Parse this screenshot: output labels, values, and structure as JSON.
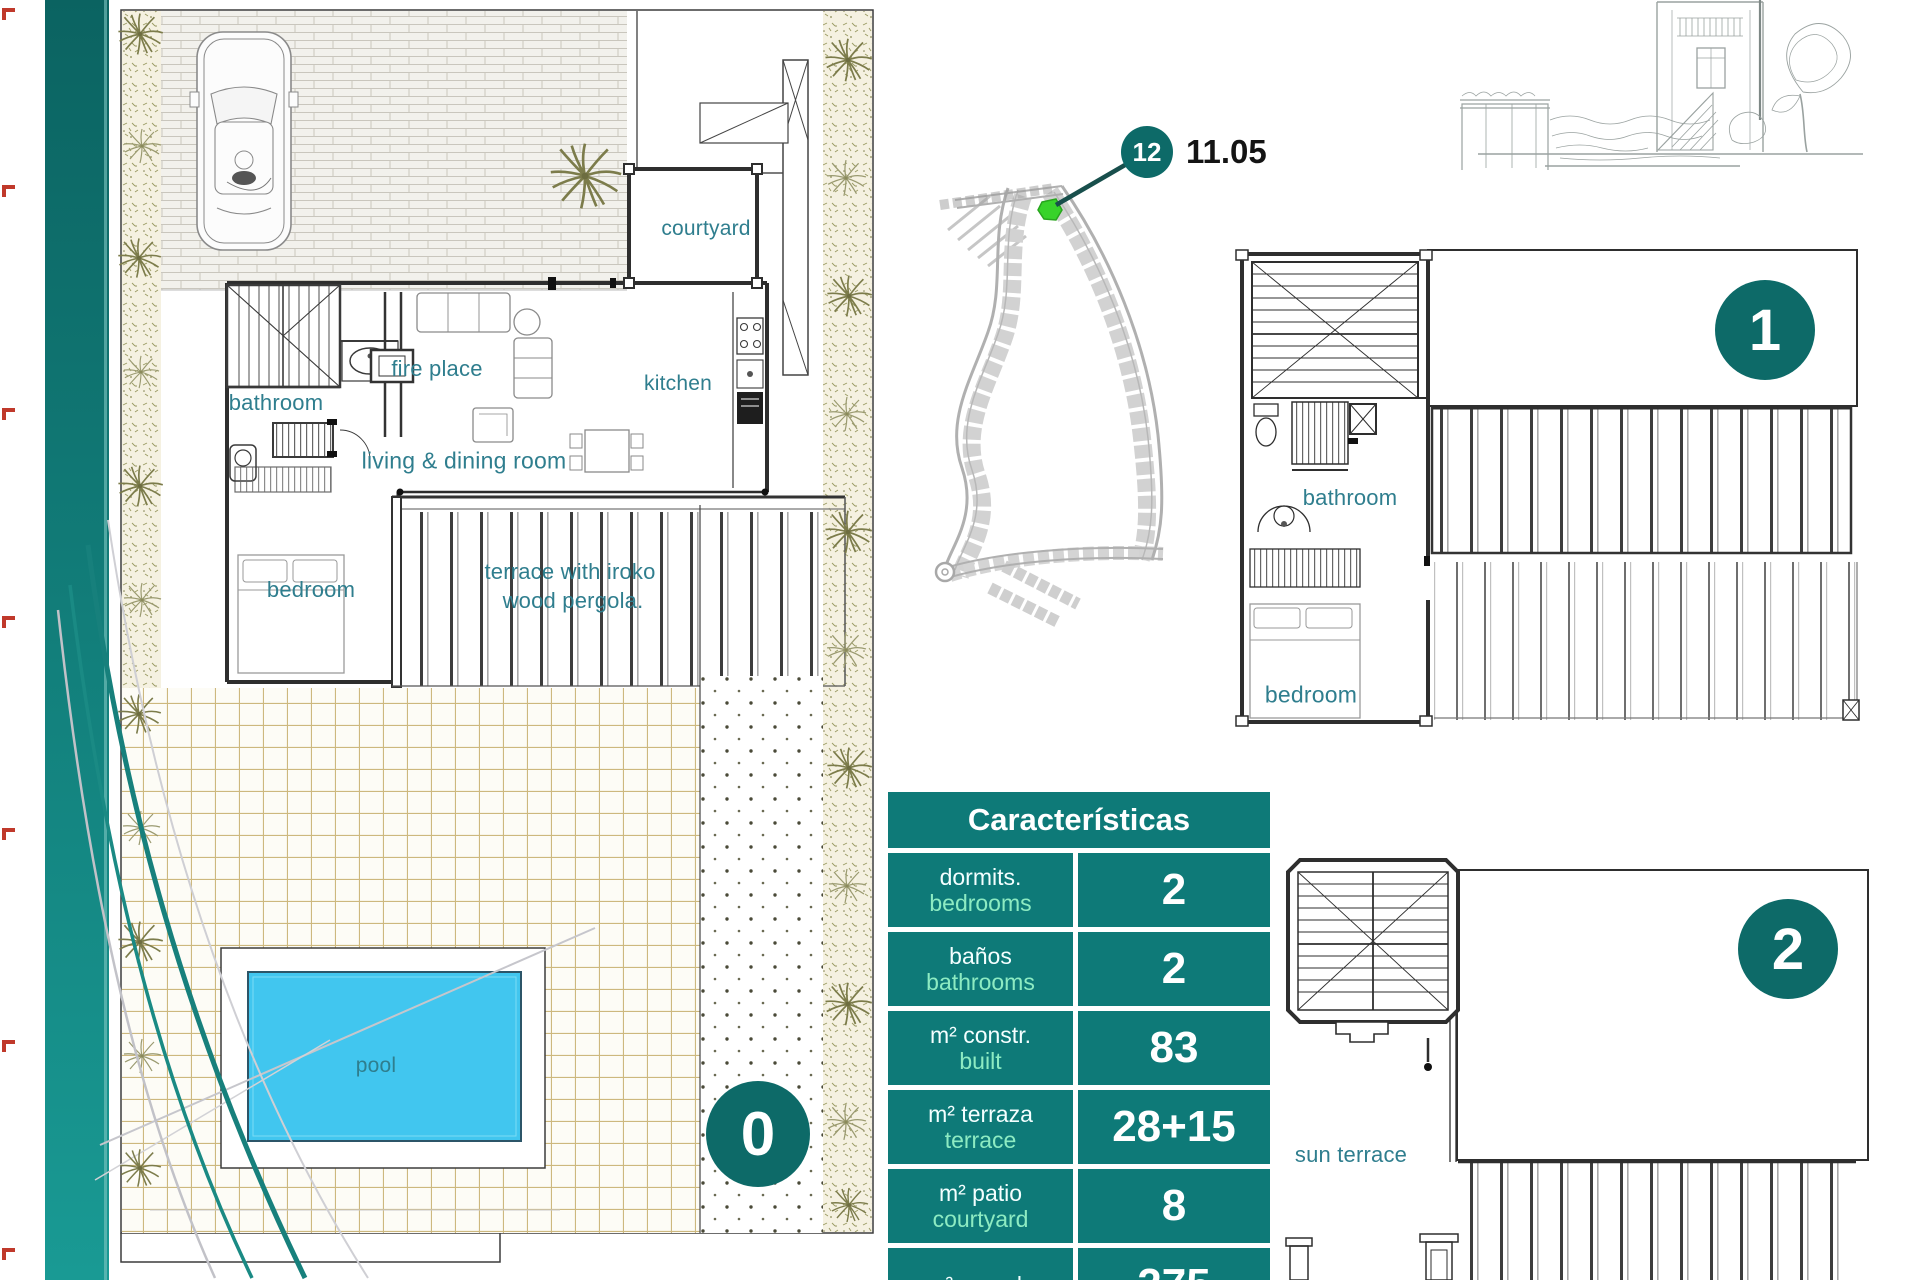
{
  "colors": {
    "teal_badge": "#0d6a68",
    "teal_table": "#0e7a78",
    "mint_text": "#8debc2",
    "room_label": "#2f7e8e",
    "pool_blue": "#41c6ef",
    "plot_marker_green": "#38d32a",
    "margin_mark_red": "#c0392b"
  },
  "ground_floor": {
    "badge": "0",
    "labels": {
      "courtyard": "courtyard",
      "kitchen": "kitchen",
      "fire_place": "fire place",
      "bathroom": "bathroom",
      "living_dining": "living & dining room",
      "bedroom": "bedroom",
      "terrace_line1": "terrace with iroko",
      "terrace_line2": "wood pergola.",
      "pool": "pool"
    }
  },
  "site_plan": {
    "plot_badge": "12",
    "elevation": "11.05"
  },
  "floor_1": {
    "badge": "1",
    "labels": {
      "bathroom": "bathroom",
      "bedroom": "bedroom"
    }
  },
  "floor_2": {
    "badge": "2",
    "labels": {
      "sun_terrace": "sun terrace"
    }
  },
  "characteristics": {
    "title": "Características",
    "rows": [
      {
        "es": "dormits.",
        "en": "bedrooms",
        "value": "2"
      },
      {
        "es": "baños",
        "en": "bathrooms",
        "value": "2"
      },
      {
        "es": "m² constr.",
        "en": "built",
        "value": "83"
      },
      {
        "es": "m² terraza",
        "en": "terrace",
        "value": "28+15"
      },
      {
        "es": "m² patio",
        "en": "courtyard",
        "value": "8"
      },
      {
        "es": "m² parcela",
        "en": "",
        "value": "275"
      }
    ]
  }
}
